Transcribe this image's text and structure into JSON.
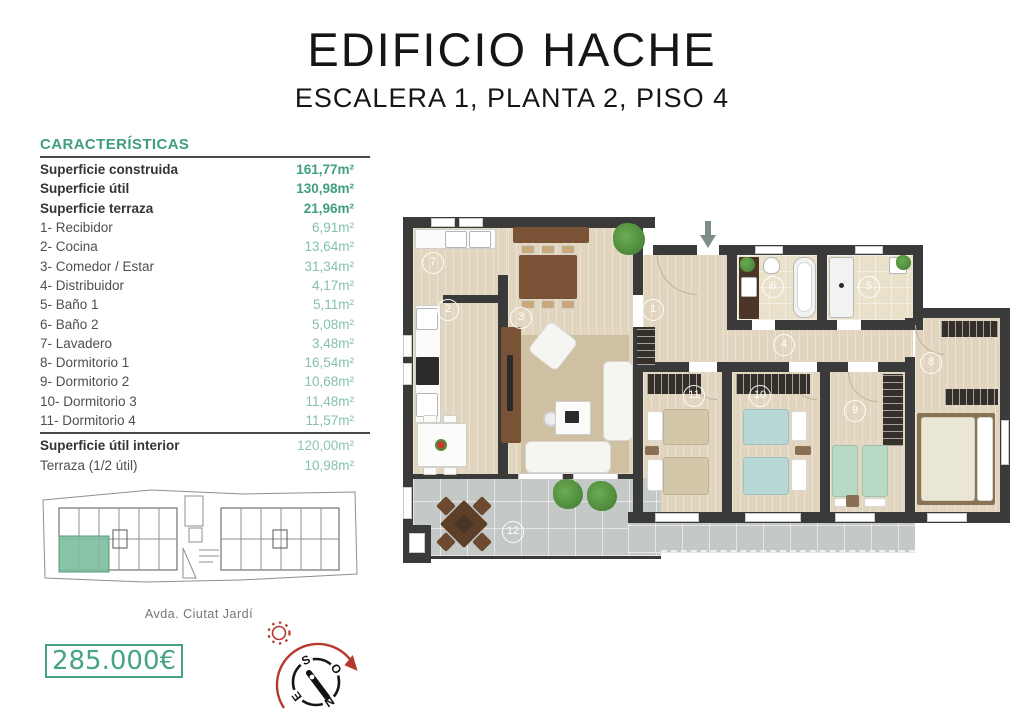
{
  "header": {
    "title": "EDIFICIO HACHE",
    "subtitle": "ESCALERA 1, PLANTA 2, PISO 4"
  },
  "characteristics": {
    "heading": "CARACTERÍSTICAS",
    "rows": [
      {
        "label": "Superficie construida",
        "value": "161,77m²",
        "kind": "bold"
      },
      {
        "label": "Superficie útil",
        "value": "130,98m²",
        "kind": "bold"
      },
      {
        "label": "Superficie terraza",
        "value": "21,96m²",
        "kind": "bold"
      },
      {
        "label": "1- Recibidor",
        "value": "6,91m²",
        "kind": "room"
      },
      {
        "label": "2- Cocina",
        "value": "13,64m²",
        "kind": "room"
      },
      {
        "label": "3- Comedor / Estar",
        "value": "31,34m²",
        "kind": "room"
      },
      {
        "label": "4- Distribuidor",
        "value": "4,17m²",
        "kind": "room"
      },
      {
        "label": "5- Baño 1",
        "value": "5,11m²",
        "kind": "room"
      },
      {
        "label": "6- Baño 2",
        "value": "5,08m²",
        "kind": "room"
      },
      {
        "label": "7- Lavadero",
        "value": "3,48m²",
        "kind": "room"
      },
      {
        "label": "8- Dormitorio 1",
        "value": "16,54m²",
        "kind": "room"
      },
      {
        "label": "9- Dormitorio 2",
        "value": "10,68m²",
        "kind": "room"
      },
      {
        "label": "10- Dormitorio 3",
        "value": "11,48m²",
        "kind": "room"
      },
      {
        "label": "11- Dormitorio 4",
        "value": "11,57m²",
        "kind": "room"
      }
    ],
    "totals": [
      {
        "label": "Superficie útil interior",
        "value": "120,00m²",
        "kind": "total-bold"
      },
      {
        "label": "Terraza (1/2 útil)",
        "value": "10,98m²",
        "kind": "room"
      }
    ]
  },
  "floorplan": {
    "room_markers": [
      {
        "n": "1",
        "x": 250,
        "y": 95
      },
      {
        "n": "2",
        "x": 45,
        "y": 95
      },
      {
        "n": "3",
        "x": 118,
        "y": 103
      },
      {
        "n": "4",
        "x": 381,
        "y": 130
      },
      {
        "n": "5",
        "x": 466,
        "y": 72
      },
      {
        "n": "6",
        "x": 370,
        "y": 72
      },
      {
        "n": "7",
        "x": 30,
        "y": 48
      },
      {
        "n": "8",
        "x": 528,
        "y": 148
      },
      {
        "n": "9",
        "x": 452,
        "y": 196
      },
      {
        "n": "10",
        "x": 357,
        "y": 181
      },
      {
        "n": "11",
        "x": 291,
        "y": 181
      },
      {
        "n": "12",
        "x": 110,
        "y": 317
      }
    ]
  },
  "siteplan": {
    "street": "Avda. Ciutat Jardí"
  },
  "price": {
    "amount": "285.000€"
  },
  "compass": {
    "letters": {
      "n": "N",
      "s": "S",
      "e": "E",
      "w": "O"
    }
  },
  "colors": {
    "green": "#3f9f7b",
    "green_light": "#85c2a7",
    "highlight": "#7cbc9e",
    "wall": "#3a3a3a",
    "floor": "#e2d5bf",
    "terrace": "#c4c9c8",
    "red": "#b5392c"
  }
}
